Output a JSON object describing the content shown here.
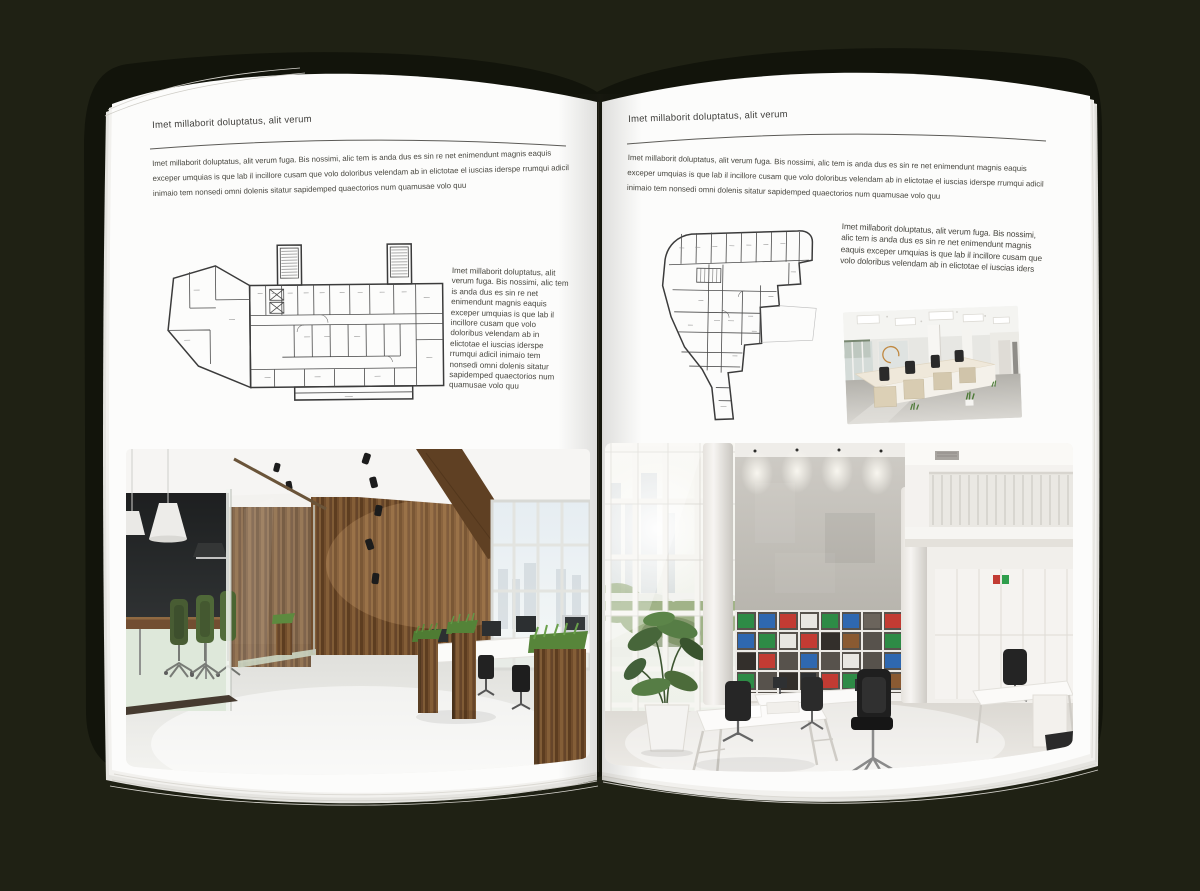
{
  "book": {
    "background_color": "#1f2114",
    "cover_color": "#12140b",
    "page_color": "#fcfcfb",
    "text_color": "#3f3e3b"
  },
  "left_page": {
    "header": "Imet millaborit doluptatus, alit verum",
    "intro": "Imet millaborit doluptatus, alit verum fuga. Bis nossimi, alic tem is anda dus es sin re net enimendunt magnis eaquis exceper umquias is que lab il incillore cusam que volo doloribus velendam ab in elictotae el iuscias iderspe rrumqui adicil inimaio tem nonsedi omni dolenis sitatur sapidemped quaectorios num quamusae volo quu",
    "side_text": "Imet millaborit doluptatus, alit verum fuga. Bis nossimi, alic tem is anda dus es sin re net enimendunt magnis eaquis exceper umquias is que lab il incillore cusam que volo doloribus velendam ab in elictotae el iuscias iderspe rrumqui adicil inimaio tem nonsedi omni dolenis sitatur sapidemped quaectorios num quamusae volo quu",
    "floor_plan": "architectural-floor-plan",
    "photo": "loft-office-glass-meeting-room-wood-wall"
  },
  "right_page": {
    "header": "Imet millaborit doluptatus, alit verum",
    "intro": "Imet millaborit doluptatus, alit verum fuga. Bis nossimi, alic tem is anda dus es sin re net enimendunt magnis eaquis exceper umquias is que lab il incillore cusam que volo doloribus velendam ab in elictotae el iuscias iderspe rrumqui adicil inimaio tem nonsedi omni dolenis sitatur sapidemped quaectorios num quamusae volo quu",
    "side_text": "Imet millaborit doluptatus, alit verum fuga. Bis nossimi, alic tem is anda dus es sin re net enimendunt magnis eaquis exceper umquias is que lab il incillore cusam que volo doloribus velendam ab in elictotae el iuscias iders",
    "floor_plan": "architectural-floor-plan",
    "photo_small": "white-open-office-desk-rows",
    "photo_large": "double-height-white-office-binder-shelves"
  }
}
